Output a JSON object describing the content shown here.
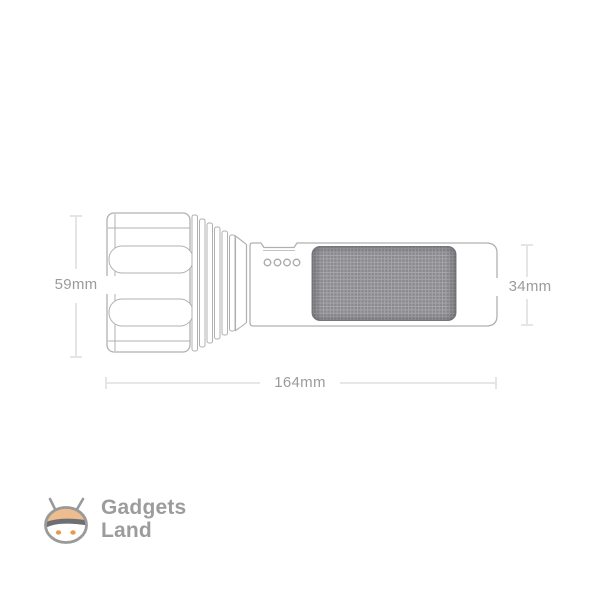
{
  "diagram": {
    "subject": "flashlight-technical-dimension-drawing",
    "dimensions": {
      "head_diameter": "59mm",
      "body_diameter": "34mm",
      "total_length": "164mm"
    },
    "indicator_dots_count": 4,
    "colors": {
      "outline": "#b0b0b0",
      "dimension_line": "#cfcfcf",
      "dimension_text": "#9b9b9b",
      "grip_base": "#8a8a8e",
      "grip_texture_line": "#a7a7ab"
    }
  },
  "logo": {
    "brand_line1": "Gadgets",
    "brand_line2": "Land",
    "icon": "gadgets-land-mascot-icon",
    "colors": {
      "text": "#9c9c9c",
      "cap": "#edbd90",
      "visor": "#6e6f73",
      "eyes": "#e59a55",
      "outline": "#9a9a9a"
    }
  }
}
